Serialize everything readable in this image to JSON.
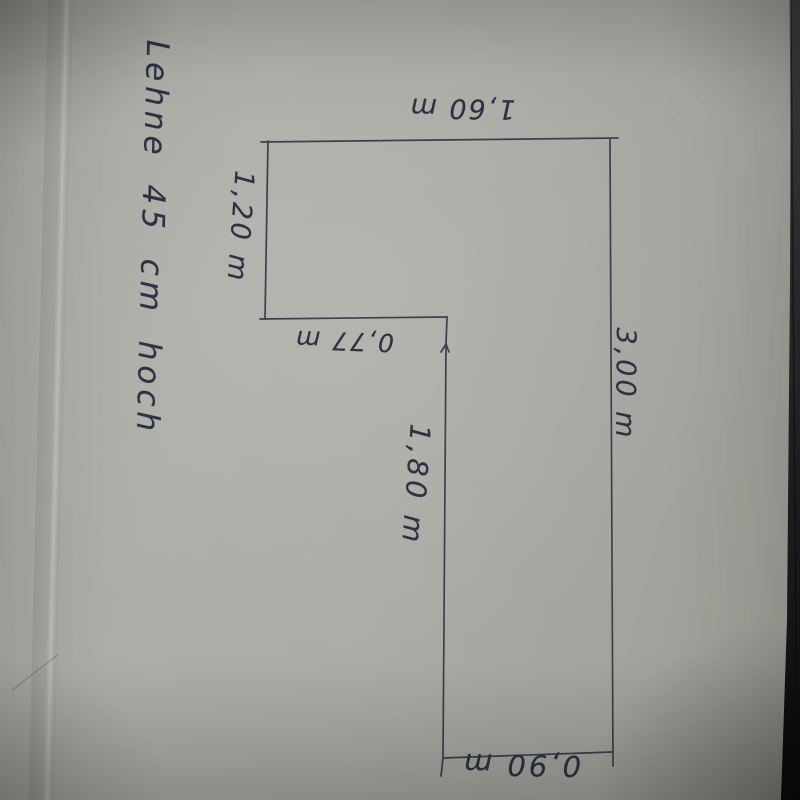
{
  "sketch": {
    "ink_color": "#3a4050",
    "handwriting_color": "#2d3344",
    "paper_color": "#aaaaa4",
    "note": "Lehne 45 cm hoch",
    "dimensions": {
      "top": "1,60 m",
      "left": "1,20 m",
      "step": "0,77 m",
      "right": "3,00 m",
      "middle": "1,80 m",
      "bottom": "0,90 m"
    },
    "outline_segments": [
      {
        "name": "top-edge",
        "points": [
          [
            261,
            142
          ],
          [
            618,
            138
          ]
        ]
      },
      {
        "name": "left-edge",
        "points": [
          [
            268,
            141
          ],
          [
            265,
            319
          ]
        ]
      },
      {
        "name": "step-edge",
        "points": [
          [
            260,
            319
          ],
          [
            447,
            317
          ]
        ]
      },
      {
        "name": "middle-edge",
        "points": [
          [
            447,
            317
          ],
          [
            446,
            344
          ],
          [
            443,
            758
          ]
        ]
      },
      {
        "name": "middle-kink",
        "points": [
          [
            441,
            352
          ],
          [
            446,
            344
          ],
          [
            449,
            352
          ]
        ]
      },
      {
        "name": "bottom-edge",
        "points": [
          [
            443,
            758
          ],
          [
            612,
            752
          ]
        ]
      },
      {
        "name": "bottom-left-tick",
        "points": [
          [
            443,
            758
          ],
          [
            441,
            776
          ]
        ]
      },
      {
        "name": "right-edge",
        "points": [
          [
            610,
            139
          ],
          [
            613,
            766
          ]
        ]
      }
    ]
  }
}
